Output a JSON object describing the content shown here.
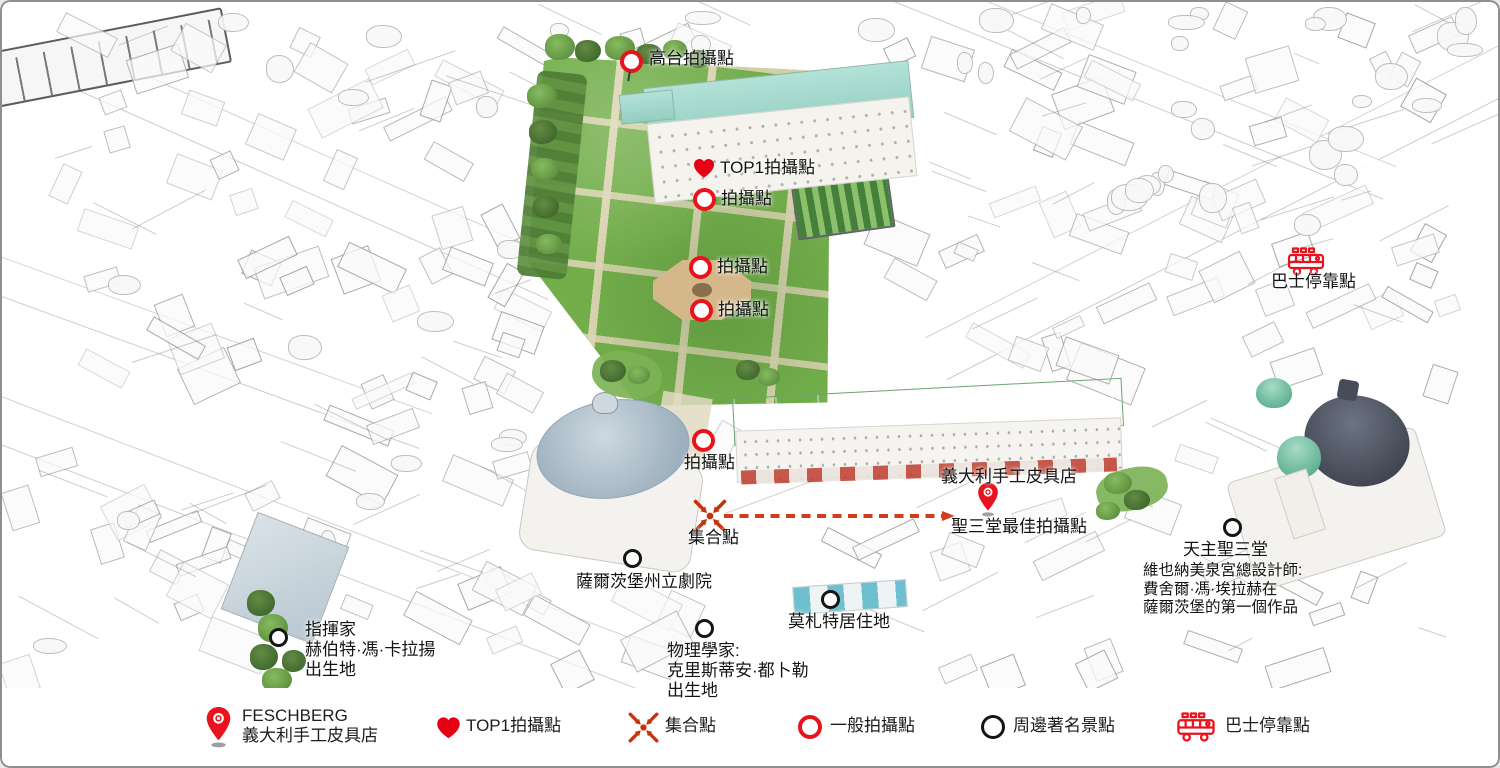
{
  "colors": {
    "marker_red": "#e8131c",
    "heart_red": "#e60013",
    "meeting_orange": "#c5330c",
    "route_red": "#d23c1e",
    "poi_black": "#151515"
  },
  "map": {
    "markers": [
      {
        "id": "elevated-photo-spot",
        "icon": "circle-red",
        "x": 631,
        "y": 61,
        "stem": true,
        "label": {
          "x": 649,
          "y": 49,
          "lines": [
            "高台拍攝點"
          ]
        }
      },
      {
        "id": "top1-photo-spot",
        "icon": "heart",
        "x": 704,
        "y": 168,
        "label": {
          "x": 720,
          "y": 158,
          "lines": [
            "TOP1拍攝點"
          ]
        }
      },
      {
        "id": "photo-spot-1",
        "icon": "circle-red",
        "x": 704,
        "y": 199,
        "label": {
          "x": 721,
          "y": 189,
          "lines": [
            "拍攝點"
          ]
        }
      },
      {
        "id": "photo-spot-2",
        "icon": "circle-red",
        "x": 700,
        "y": 267,
        "label": {
          "x": 717,
          "y": 257,
          "lines": [
            "拍攝點"
          ]
        }
      },
      {
        "id": "photo-spot-3",
        "icon": "circle-red",
        "x": 701,
        "y": 310,
        "label": {
          "x": 718,
          "y": 300,
          "lines": [
            "拍攝點"
          ]
        }
      },
      {
        "id": "photo-spot-4",
        "icon": "circle-red",
        "x": 703,
        "y": 440,
        "label": {
          "x": 684,
          "y": 453,
          "lines": [
            "拍攝點"
          ]
        }
      },
      {
        "id": "meeting-point",
        "icon": "meeting",
        "x": 710,
        "y": 516,
        "label": {
          "x": 688,
          "y": 528,
          "lines": [
            "集合點"
          ]
        }
      },
      {
        "id": "state-theatre",
        "icon": "circle-black",
        "x": 632,
        "y": 558,
        "label": {
          "x": 576,
          "y": 572,
          "lines": [
            "薩爾茨堡州立劇院"
          ]
        }
      },
      {
        "id": "italian-leather-shop",
        "icon": "pin",
        "x": 988,
        "y": 517,
        "label": {
          "x": 941,
          "y": 467,
          "lines": [
            "義大利手工皮具店"
          ]
        }
      },
      {
        "id": "trinity-church",
        "icon": "circle-black",
        "x": 1232,
        "y": 527,
        "label": {
          "x": 1183,
          "y": 540,
          "lines": [
            "天主聖三堂"
          ]
        },
        "sub": {
          "x": 1143,
          "y": 562,
          "lines": [
            "維也納美泉宮總設計師:",
            "費舍爾·馮·埃拉赫在",
            "薩爾茨堡的第一個作品"
          ]
        }
      },
      {
        "id": "bus-stop",
        "icon": "bus",
        "x": 1307,
        "y": 262,
        "label": {
          "x": 1271,
          "y": 272,
          "lines": [
            "巴士停靠點"
          ]
        }
      },
      {
        "id": "mozart-residence",
        "icon": "circle-black",
        "x": 830,
        "y": 599,
        "label": {
          "x": 788,
          "y": 612,
          "lines": [
            "莫札特居住地"
          ]
        }
      },
      {
        "id": "karajan-birthplace",
        "icon": "circle-black",
        "x": 278,
        "y": 637,
        "label": {
          "x": 305,
          "y": 620,
          "lines": [
            "指揮家",
            "赫伯特·馮·卡拉揚",
            "出生地"
          ]
        }
      },
      {
        "id": "doppler-birthplace",
        "icon": "circle-black",
        "x": 704,
        "y": 628,
        "label": {
          "x": 667,
          "y": 641,
          "lines": [
            "物理學家:",
            "克里斯蒂安·都卜勒",
            "出生地"
          ]
        }
      }
    ],
    "route": {
      "x1": 724,
      "y": 516,
      "x2": 944,
      "label": {
        "x": 951,
        "y": 517,
        "lines": [
          "聖三堂最佳拍攝點"
        ]
      }
    }
  },
  "legend": {
    "items": [
      {
        "id": "shop-pin",
        "icon": "pin",
        "lines": [
          "FESCHBERG",
          "義大利手工皮具店"
        ]
      },
      {
        "id": "top1-photo",
        "icon": "heart",
        "lines": [
          "TOP1拍攝點"
        ]
      },
      {
        "id": "meeting",
        "icon": "meeting",
        "lines": [
          "集合點"
        ]
      },
      {
        "id": "general-photo",
        "icon": "circle-red",
        "lines": [
          "一般拍攝點"
        ]
      },
      {
        "id": "famous-poi",
        "icon": "circle-black",
        "lines": [
          "周邊著名景點"
        ]
      },
      {
        "id": "bus-stop",
        "icon": "bus",
        "lines": [
          "巴士停靠點"
        ]
      }
    ]
  }
}
